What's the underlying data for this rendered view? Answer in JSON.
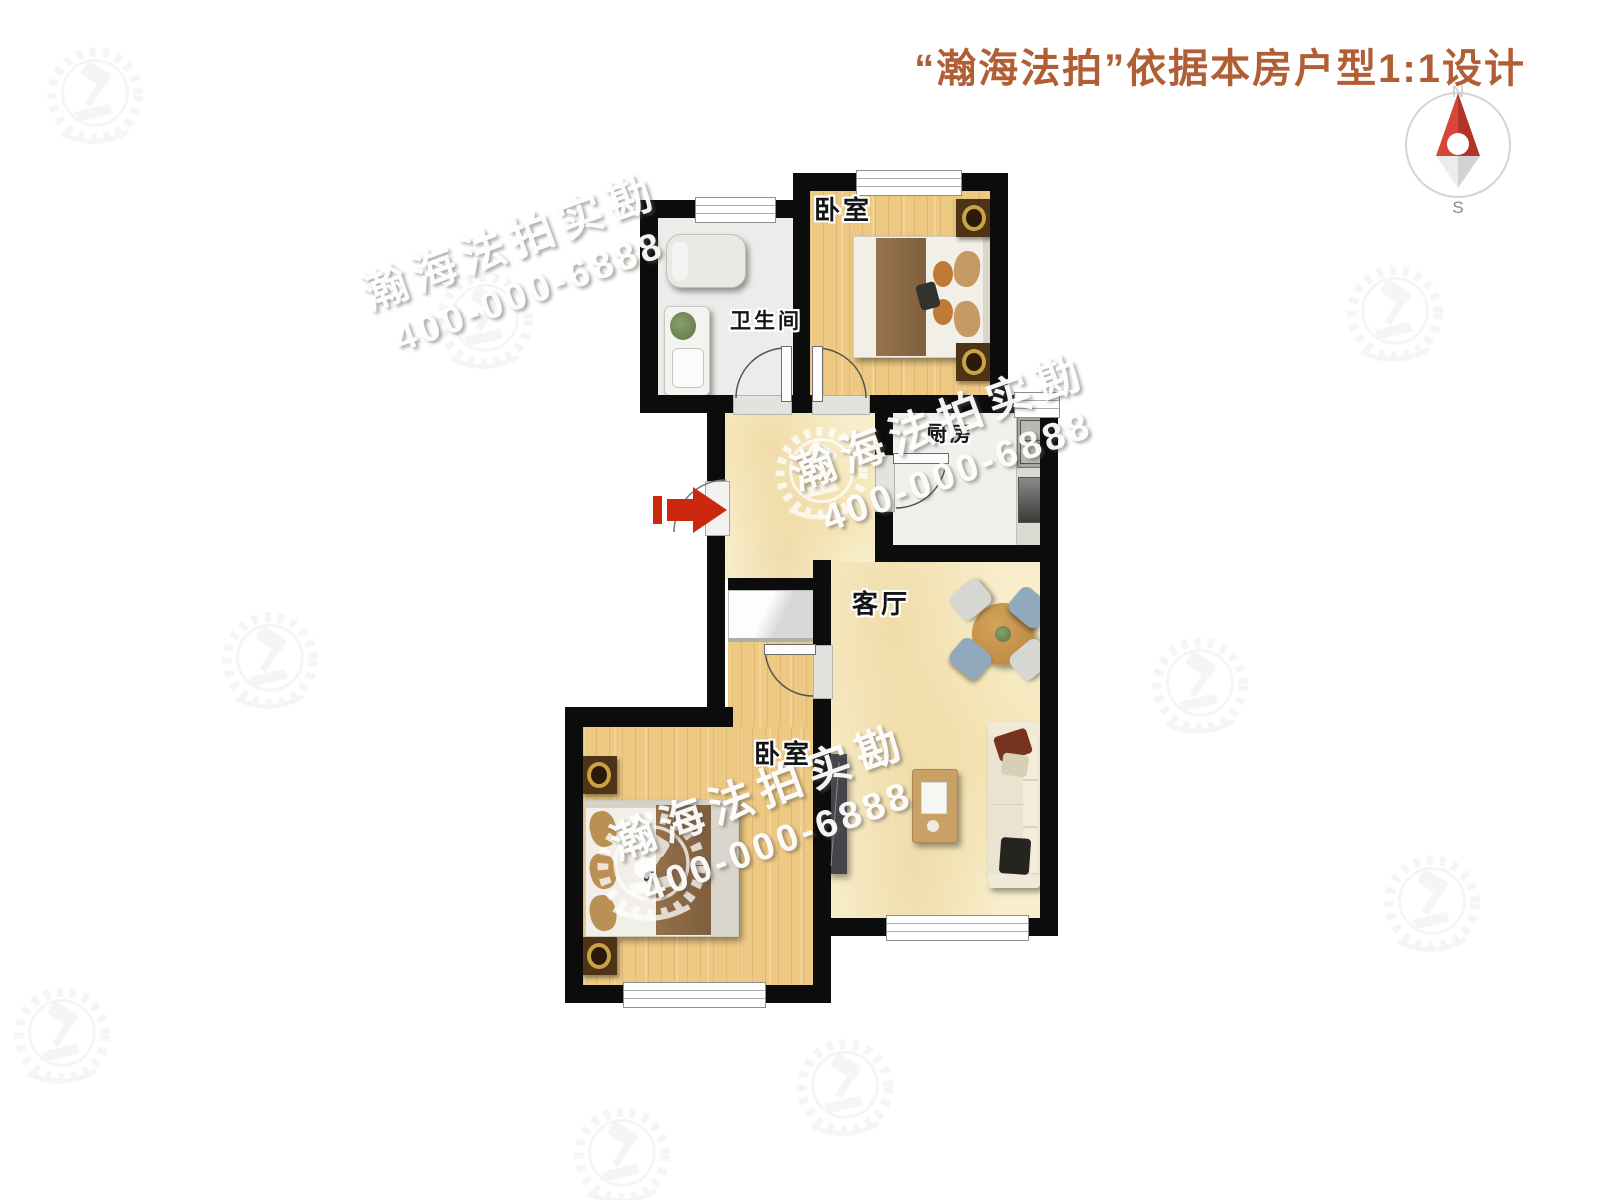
{
  "header": {
    "title": "“瀚海法拍”依据本房户型1:1设计"
  },
  "compass": {
    "north_label": "N",
    "south_label": "S"
  },
  "rooms": {
    "bathroom": {
      "label": "卫生间"
    },
    "bedroom_top": {
      "label": "卧室"
    },
    "kitchen": {
      "label": "厨房"
    },
    "living_room": {
      "label": "客厅"
    },
    "bedroom_bottom": {
      "label": "卧室"
    }
  },
  "watermark": {
    "brand": "瀚海法拍实勘",
    "phone": "400-000-6888"
  },
  "colors": {
    "accent_title": "#b15e35",
    "wall": "#0c0c0c",
    "entry_arrow_red": "#cc2810",
    "wood_floor": "#edc983",
    "tile_floor": "#f8eecb",
    "compass_red": "#c0392b"
  }
}
